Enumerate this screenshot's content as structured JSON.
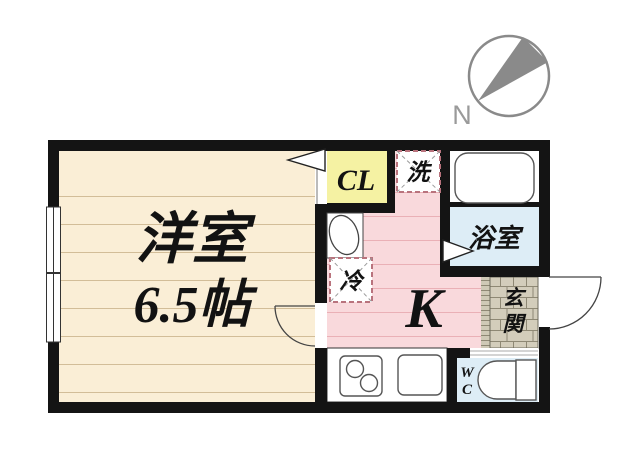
{
  "compass": {
    "north_label": "N"
  },
  "plan": {
    "western_room": {
      "name": "洋室",
      "area": "6.5帖"
    },
    "closet": {
      "label": "CL"
    },
    "laundry": {
      "label": "洗"
    },
    "bathroom": {
      "label": "浴室"
    },
    "kitchen": {
      "label": "K"
    },
    "refrigerator": {
      "label": "冷"
    },
    "entrance": {
      "char1": "玄",
      "char2": "関"
    },
    "toilet": {
      "char1": "W",
      "char2": "C"
    }
  },
  "colors": {
    "wall": "#141414",
    "western_room_floor": "#faeed6",
    "closet": "#f5f2a3",
    "kitchen_floor": "#f9d9dc",
    "bathroom_floor": "#ddedf6",
    "toilet_floor": "#ddedf6",
    "entrance_tile": "#d3cdbb",
    "compass": "#8a8a8a"
  }
}
